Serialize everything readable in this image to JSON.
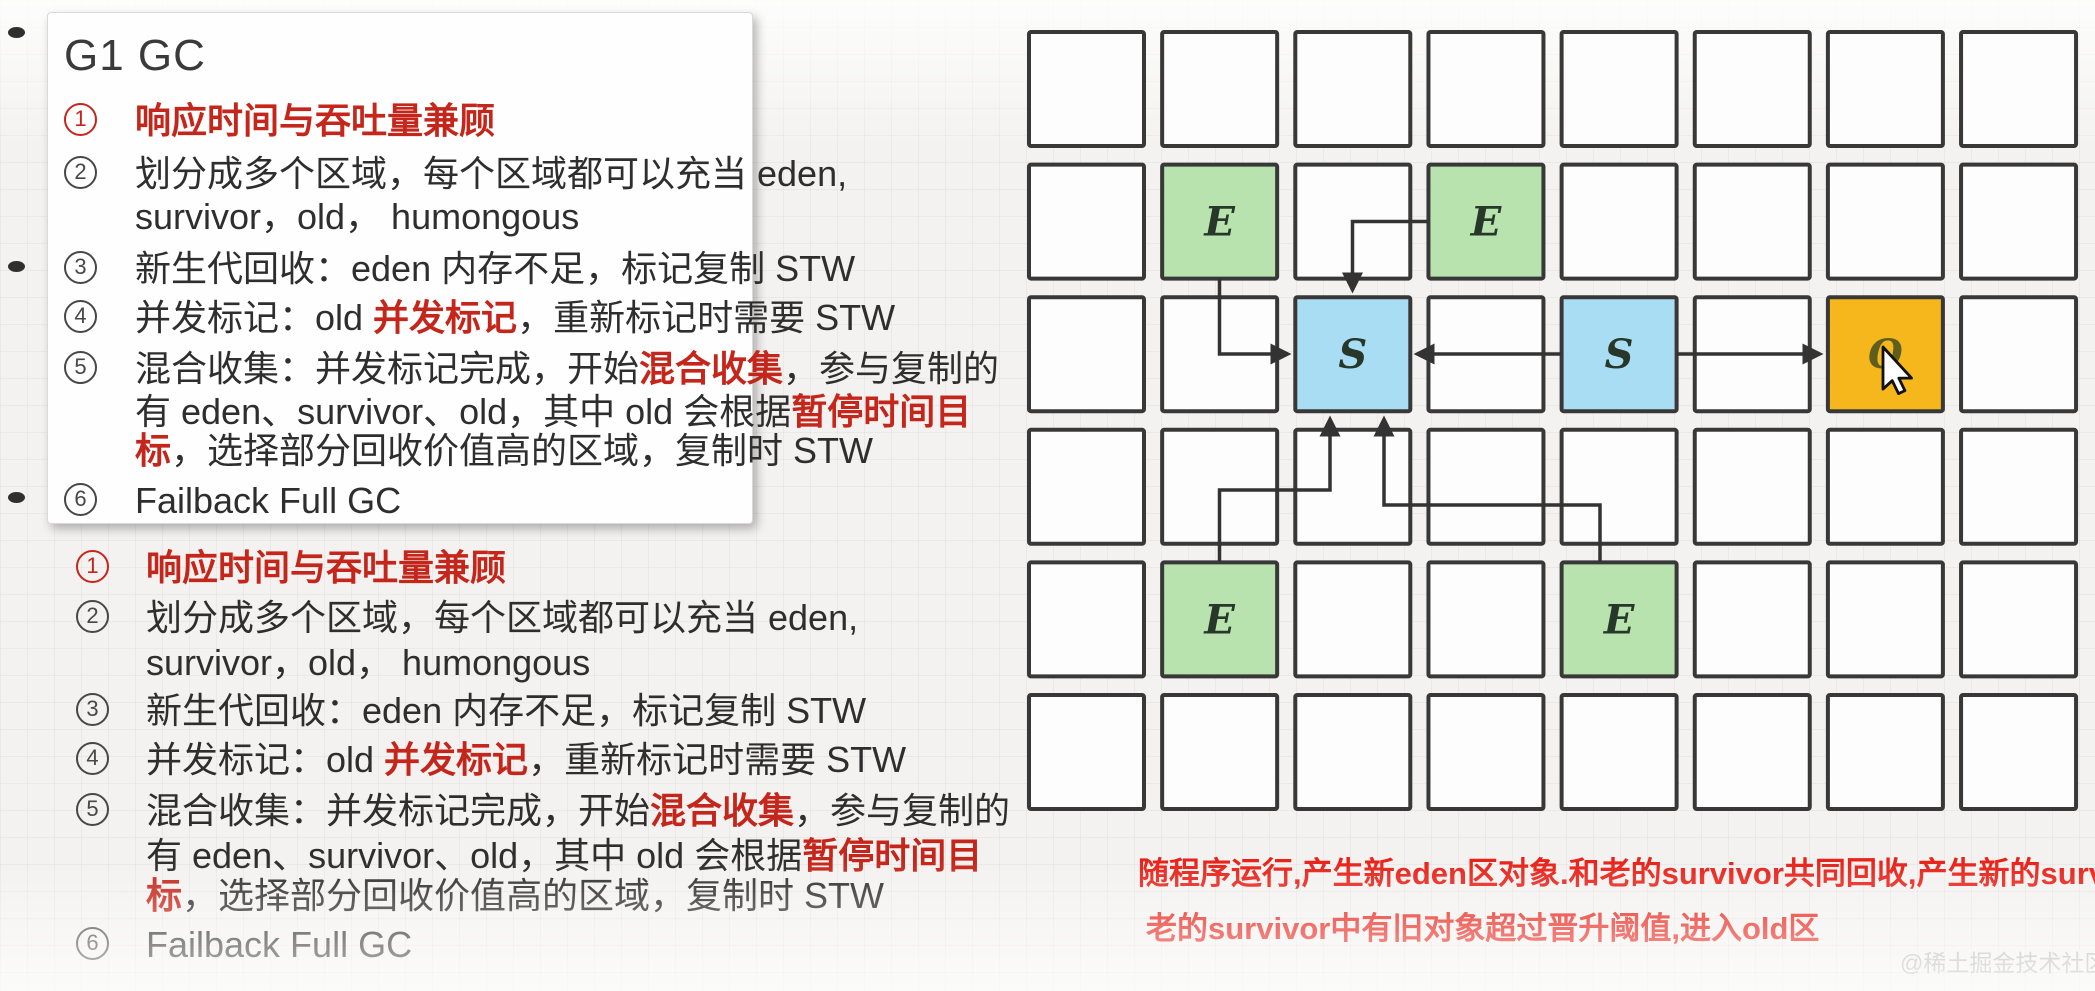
{
  "notes_card": {
    "title": "G1 GC",
    "lines": [
      {
        "num": "1",
        "num_red": true,
        "segments": [
          {
            "t": "响应时间与吞吐量兼顾",
            "red": true
          }
        ]
      },
      {
        "num": "2",
        "num_red": false,
        "segments": [
          {
            "t": "划分成多个区域，每个区域都可以充当 eden,",
            "red": false
          }
        ]
      },
      {
        "num": null,
        "segments": [
          {
            "t": "survivor，old， humongous",
            "red": false
          }
        ]
      },
      {
        "num": "3",
        "num_red": false,
        "segments": [
          {
            "t": "新生代回收：eden 内存不足，标记复制 STW",
            "red": false
          }
        ]
      },
      {
        "num": "4",
        "num_red": false,
        "segments": [
          {
            "t": "并发标记：old ",
            "red": false
          },
          {
            "t": "并发标记",
            "red": true
          },
          {
            "t": "，重新标记时需要 STW",
            "red": false
          }
        ]
      },
      {
        "num": "5",
        "num_red": false,
        "segments": [
          {
            "t": "混合收集：并发标记完成，开始",
            "red": false
          },
          {
            "t": "混合收集",
            "red": true
          },
          {
            "t": "，参与复制的",
            "red": false
          }
        ]
      },
      {
        "num": null,
        "segments": [
          {
            "t": "有 eden、survivor、old，其中 old 会根据",
            "red": false
          },
          {
            "t": "暂停时间目",
            "red": true
          }
        ]
      },
      {
        "num": null,
        "segments": [
          {
            "t": "标",
            "red": true
          },
          {
            "t": "，选择部分回收价值高的区域，复制时 STW",
            "red": false
          }
        ]
      },
      {
        "num": "6",
        "num_red": false,
        "segments": [
          {
            "t": "Failback Full GC",
            "red": false
          }
        ]
      }
    ]
  },
  "notes_repeat": {
    "lines": [
      {
        "num": "1",
        "num_red": true,
        "segments": [
          {
            "t": "响应时间与吞吐量兼顾",
            "red": true
          }
        ]
      },
      {
        "num": "2",
        "num_red": false,
        "segments": [
          {
            "t": "划分成多个区域，每个区域都可以充当 eden,",
            "red": false
          }
        ]
      },
      {
        "num": null,
        "segments": [
          {
            "t": "survivor，old， humongous",
            "red": false
          }
        ]
      },
      {
        "num": "3",
        "num_red": false,
        "segments": [
          {
            "t": "新生代回收：eden 内存不足，标记复制 STW",
            "red": false
          }
        ]
      },
      {
        "num": "4",
        "num_red": false,
        "segments": [
          {
            "t": "并发标记：old ",
            "red": false
          },
          {
            "t": "并发标记",
            "red": true
          },
          {
            "t": "，重新标记时需要 STW",
            "red": false
          }
        ]
      },
      {
        "num": "5",
        "num_red": false,
        "segments": [
          {
            "t": "混合收集：并发标记完成，开始",
            "red": false
          },
          {
            "t": "混合收集",
            "red": true
          },
          {
            "t": "，参与复制的",
            "red": false
          }
        ]
      },
      {
        "num": null,
        "segments": [
          {
            "t": "有 eden、survivor、old，其中 old 会根据",
            "red": false
          },
          {
            "t": "暂停时间目",
            "red": true
          }
        ]
      },
      {
        "num": null,
        "segments": [
          {
            "t": "标",
            "red": true
          },
          {
            "t": "，选择部分回收价值高的区域，复制时 STW",
            "red": false
          }
        ]
      },
      {
        "num": "6",
        "num_red": false,
        "segments": [
          {
            "t": "Failback Full GC",
            "red": false
          }
        ]
      }
    ]
  },
  "diagram": {
    "grid": {
      "rows": 6,
      "cols": 8
    },
    "cells": [
      {
        "row": 2,
        "col": 2,
        "type": "eden",
        "label": "E"
      },
      {
        "row": 2,
        "col": 4,
        "type": "eden",
        "label": "E"
      },
      {
        "row": 3,
        "col": 3,
        "type": "survivor",
        "label": "S"
      },
      {
        "row": 3,
        "col": 5,
        "type": "survivor",
        "label": "S"
      },
      {
        "row": 3,
        "col": 7,
        "type": "old",
        "label": "O"
      },
      {
        "row": 5,
        "col": 2,
        "type": "eden",
        "label": "E"
      },
      {
        "row": 5,
        "col": 5,
        "type": "eden",
        "label": "E"
      }
    ],
    "annotations": [
      "随程序运行,产生新eden区对象.和老的survivor共同回收,产生新的survivor区",
      "老的survivor中有旧对象超过晋升阈值,进入old区"
    ]
  },
  "watermark": "@稀土掘金技术社区",
  "colors": {
    "accent_red": "#c5261b",
    "annotation_red": "#e8231a",
    "eden_green": "#b8e3ae",
    "survivor_blue": "#a9ddf4",
    "old_orange": "#f6b71c",
    "cell_border": "#383838",
    "letter_dark": "#27372a",
    "letter_old": "#5f5e1e"
  }
}
